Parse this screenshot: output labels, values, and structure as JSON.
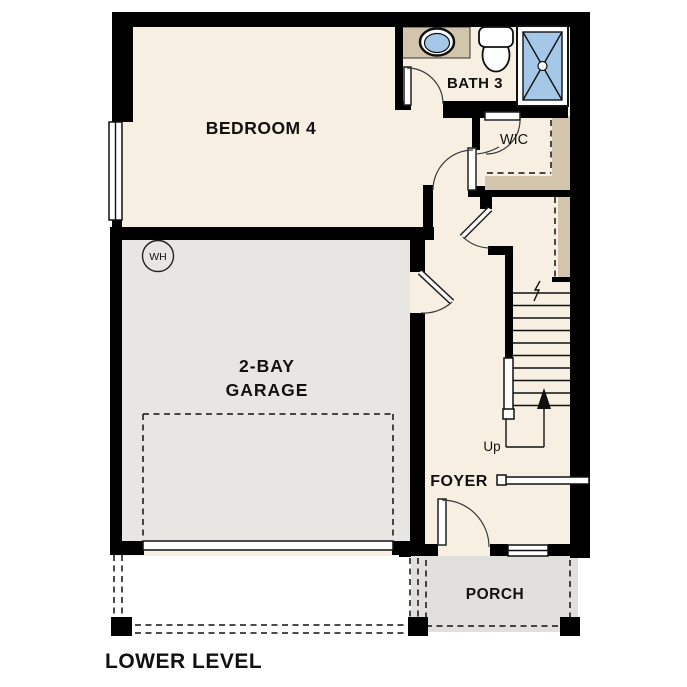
{
  "plan_title": "LOWER LEVEL",
  "rooms": {
    "bedroom4": "BEDROOM 4",
    "bath3": "BATH 3",
    "wic": "WIC",
    "garage_line1": "2-BAY",
    "garage_line2": "GARAGE",
    "foyer": "FOYER",
    "porch": "PORCH"
  },
  "annotations": {
    "water_heater": "WH",
    "stairs_direction": "Up"
  },
  "colors": {
    "wall": "#000000",
    "interior": "#f7f0e2",
    "garage_floor": "#e7e6e3",
    "porch_floor": "#e1e0dd",
    "casework": "#d2c5ab",
    "plumbing_blue": "#a6c8e8",
    "fixture_white": "#ffffff"
  }
}
